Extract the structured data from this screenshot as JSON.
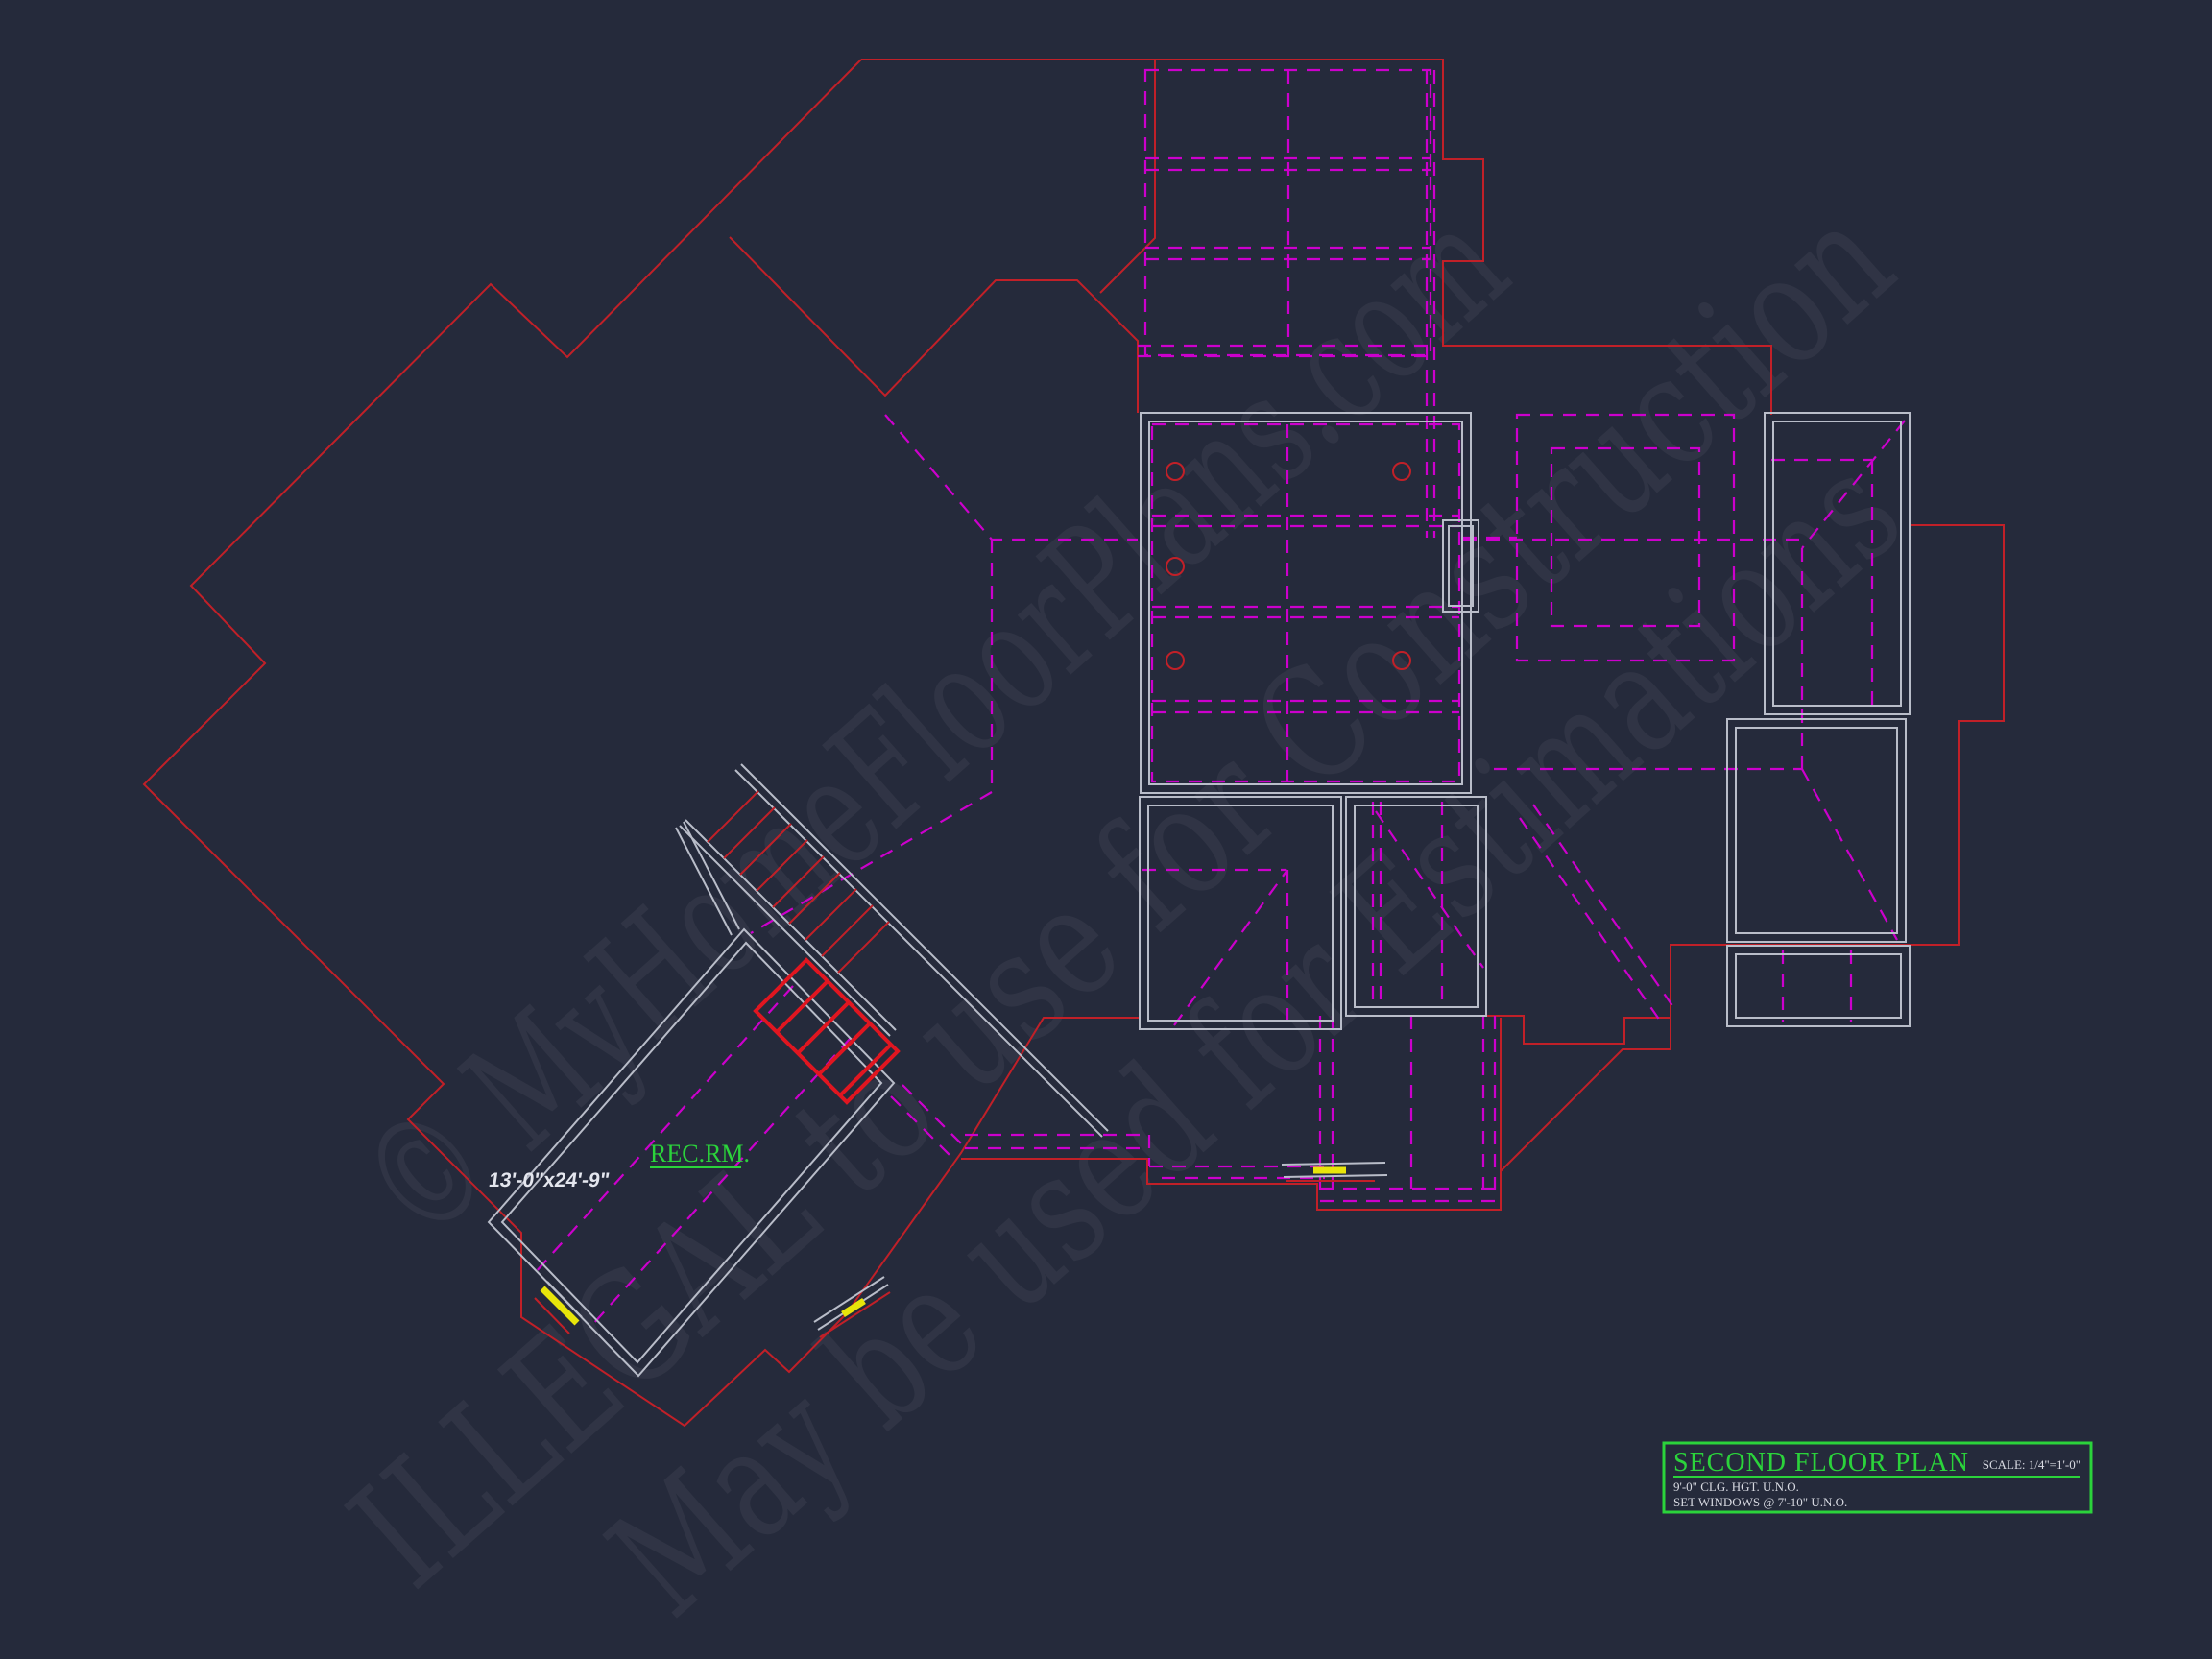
{
  "title_block": {
    "title": "SECOND FLOOR PLAN",
    "scale": "SCALE: 1/4\"=1'-0\"",
    "note_1": "9'-0\" CLG. HGT. U.N.O.",
    "note_2": "SET WINDOWS @ 7'-10\" U.N.O."
  },
  "rooms": {
    "rec_room": {
      "name": "REC.RM.",
      "dimensions": "13'-0\"x24'-9\""
    }
  },
  "watermark": {
    "line_1": "© MyHomeFloorPlans.com",
    "line_2": "ILLEGAL to use for Construction",
    "line_3": "May be used for Estimations"
  },
  "colors": {
    "background": "#252a3b",
    "roof_red": "#c12028",
    "stair_red": "#e01620",
    "wall_gray": "#b9bdc9",
    "ceiling_magenta": "#cc00cc",
    "accent_green": "#2bd33b",
    "window_yellow": "#e8e50a",
    "text_white": "#d8dae2"
  }
}
